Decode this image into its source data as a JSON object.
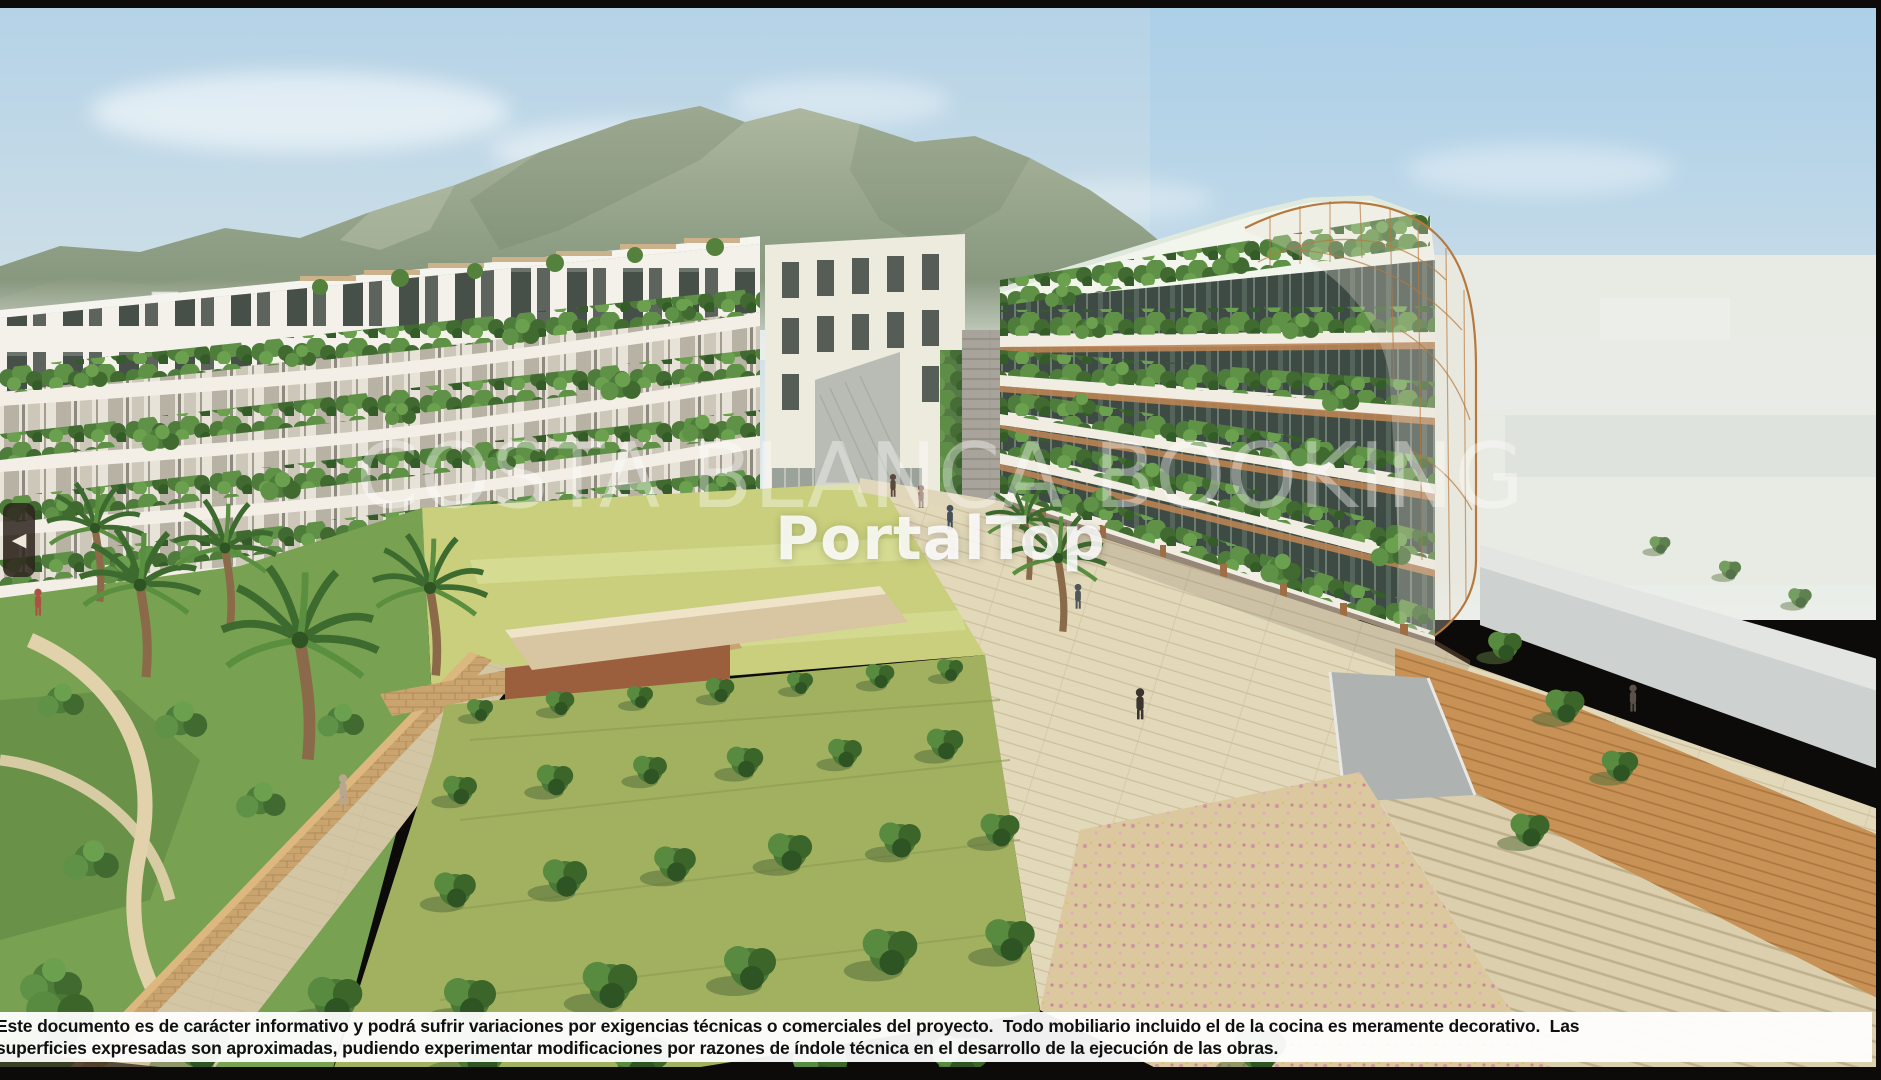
{
  "viewer": {
    "watermark_text": "COSTA BLANCA BOOKING",
    "brand_watermark": "PortalTop",
    "prev_icon_glyph": "◀",
    "disclaimer_line1": "Este documento es de carácter informativo y podrá sufrir variaciones por exigencias técnicas o comerciales del proyecto.  Todo mobiliario incluido el de la cocina es meramente decorativo.  Las",
    "disclaimer_line2": "superficies expresadas son aproximadas, pudiendo experimentar modificaciones por razones de índole técnica en el desarrollo de la ejecución de las obras."
  },
  "scene": {
    "subject": "residential-complex-architectural-render",
    "features": [
      "mountain-range",
      "terraced-apartment-building-left",
      "terraced-apartment-building-right",
      "roof-pergolas",
      "planted-balconies",
      "bronze-lattice-crown",
      "central-lawn",
      "orchard-garden",
      "palm-trees",
      "esplanade",
      "entrance-ramp",
      "brick-wall"
    ],
    "palette": {
      "sky_top": "#b4d2e7",
      "sky_horizon": "#ecefe9",
      "mountain": "#8f9f85",
      "building_white": "#f2efe6",
      "hedge_green": "#4e7c3b",
      "glazing_dark": "#3e4b44",
      "terracotta": "#bb8455",
      "lattice_bronze": "#b5793f",
      "lawn": "#c9cf7c",
      "orchard": "#a2b160",
      "paving": "#e2d8ba",
      "brick": "#c9a46f"
    }
  }
}
